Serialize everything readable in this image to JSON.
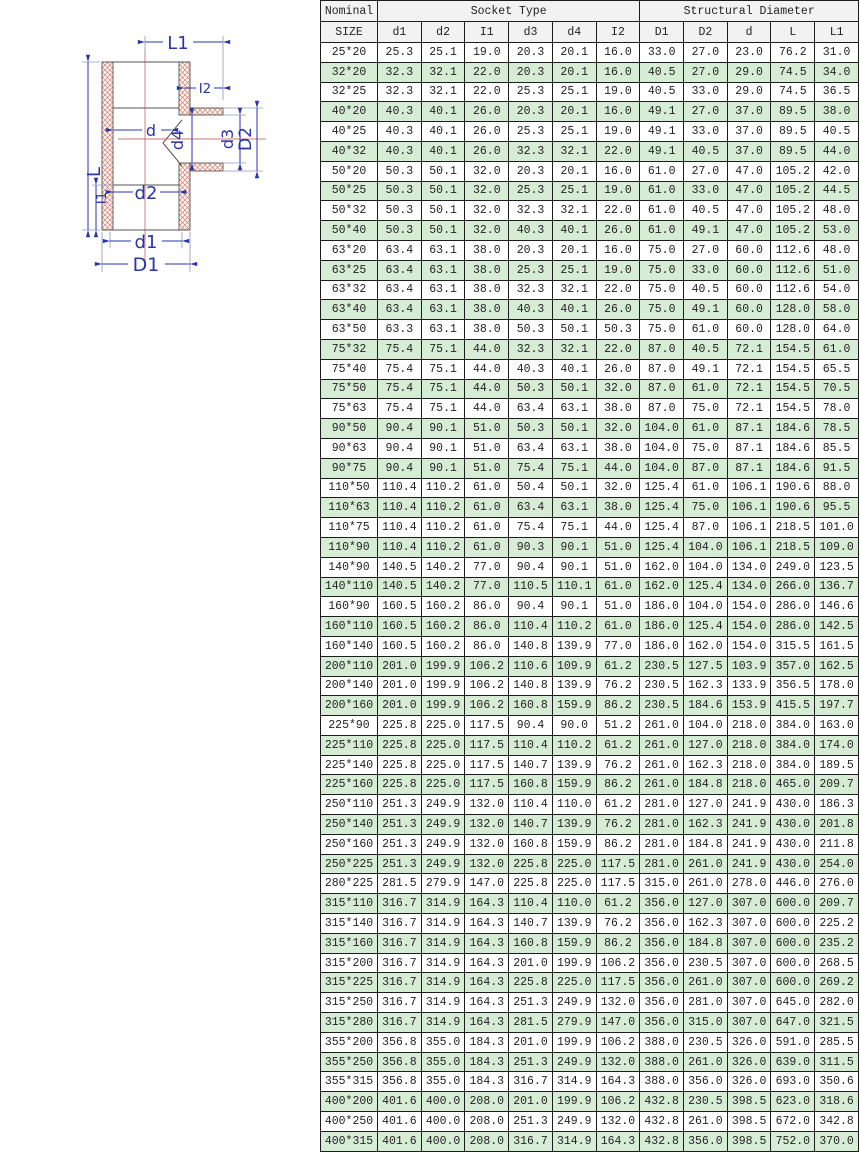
{
  "diagram": {
    "labels": {
      "L1": "L1",
      "I2": "I2",
      "d": "d",
      "d4": "d4",
      "d3": "d3",
      "D2": "D2",
      "L": "L",
      "I1": "I1",
      "d2": "d2",
      "d1": "d1",
      "D1": "D1"
    },
    "colors": {
      "dimension_blue": "#2a35a8",
      "outline_gray": "#555555",
      "hatch_red": "#cf6e5e",
      "centerline_red": "#c34a4a"
    }
  },
  "table": {
    "header": {
      "nominal": "Nominal",
      "size": "SIZE",
      "socket_group": "Socket Type",
      "structural_group": "Structural Diameter",
      "socket_cols": [
        "d1",
        "d2",
        "I1",
        "d3",
        "d4",
        "I2"
      ],
      "structural_cols": [
        "D1",
        "D2",
        "d",
        "L",
        "L1"
      ]
    },
    "row_alt_color": "#d6ecd5",
    "rows": [
      [
        "25*20",
        "25.3",
        "25.1",
        "19.0",
        "20.3",
        "20.1",
        "16.0",
        "33.0",
        "27.0",
        "23.0",
        "76.2",
        "31.0"
      ],
      [
        "32*20",
        "32.3",
        "32.1",
        "22.0",
        "20.3",
        "20.1",
        "16.0",
        "40.5",
        "27.0",
        "29.0",
        "74.5",
        "34.0"
      ],
      [
        "32*25",
        "32.3",
        "32.1",
        "22.0",
        "25.3",
        "25.1",
        "19.0",
        "40.5",
        "33.0",
        "29.0",
        "74.5",
        "36.5"
      ],
      [
        "40*20",
        "40.3",
        "40.1",
        "26.0",
        "20.3",
        "20.1",
        "16.0",
        "49.1",
        "27.0",
        "37.0",
        "89.5",
        "38.0"
      ],
      [
        "40*25",
        "40.3",
        "40.1",
        "26.0",
        "25.3",
        "25.1",
        "19.0",
        "49.1",
        "33.0",
        "37.0",
        "89.5",
        "40.5"
      ],
      [
        "40*32",
        "40.3",
        "40.1",
        "26.0",
        "32.3",
        "32.1",
        "22.0",
        "49.1",
        "40.5",
        "37.0",
        "89.5",
        "44.0"
      ],
      [
        "50*20",
        "50.3",
        "50.1",
        "32.0",
        "20.3",
        "20.1",
        "16.0",
        "61.0",
        "27.0",
        "47.0",
        "105.2",
        "42.0"
      ],
      [
        "50*25",
        "50.3",
        "50.1",
        "32.0",
        "25.3",
        "25.1",
        "19.0",
        "61.0",
        "33.0",
        "47.0",
        "105.2",
        "44.5"
      ],
      [
        "50*32",
        "50.3",
        "50.1",
        "32.0",
        "32.3",
        "32.1",
        "22.0",
        "61.0",
        "40.5",
        "47.0",
        "105.2",
        "48.0"
      ],
      [
        "50*40",
        "50.3",
        "50.1",
        "32.0",
        "40.3",
        "40.1",
        "26.0",
        "61.0",
        "49.1",
        "47.0",
        "105.2",
        "53.0"
      ],
      [
        "63*20",
        "63.4",
        "63.1",
        "38.0",
        "20.3",
        "20.1",
        "16.0",
        "75.0",
        "27.0",
        "60.0",
        "112.6",
        "48.0"
      ],
      [
        "63*25",
        "63.4",
        "63.1",
        "38.0",
        "25.3",
        "25.1",
        "19.0",
        "75.0",
        "33.0",
        "60.0",
        "112.6",
        "51.0"
      ],
      [
        "63*32",
        "63.4",
        "63.1",
        "38.0",
        "32.3",
        "32.1",
        "22.0",
        "75.0",
        "40.5",
        "60.0",
        "112.6",
        "54.0"
      ],
      [
        "63*40",
        "63.4",
        "63.1",
        "38.0",
        "40.3",
        "40.1",
        "26.0",
        "75.0",
        "49.1",
        "60.0",
        "128.0",
        "58.0"
      ],
      [
        "63*50",
        "63.3",
        "63.1",
        "38.0",
        "50.3",
        "50.1",
        "50.3",
        "75.0",
        "61.0",
        "60.0",
        "128.0",
        "64.0"
      ],
      [
        "75*32",
        "75.4",
        "75.1",
        "44.0",
        "32.3",
        "32.1",
        "22.0",
        "87.0",
        "40.5",
        "72.1",
        "154.5",
        "61.0"
      ],
      [
        "75*40",
        "75.4",
        "75.1",
        "44.0",
        "40.3",
        "40.1",
        "26.0",
        "87.0",
        "49.1",
        "72.1",
        "154.5",
        "65.5"
      ],
      [
        "75*50",
        "75.4",
        "75.1",
        "44.0",
        "50.3",
        "50.1",
        "32.0",
        "87.0",
        "61.0",
        "72.1",
        "154.5",
        "70.5"
      ],
      [
        "75*63",
        "75.4",
        "75.1",
        "44.0",
        "63.4",
        "63.1",
        "38.0",
        "87.0",
        "75.0",
        "72.1",
        "154.5",
        "78.0"
      ],
      [
        "90*50",
        "90.4",
        "90.1",
        "51.0",
        "50.3",
        "50.1",
        "32.0",
        "104.0",
        "61.0",
        "87.1",
        "184.6",
        "78.5"
      ],
      [
        "90*63",
        "90.4",
        "90.1",
        "51.0",
        "63.4",
        "63.1",
        "38.0",
        "104.0",
        "75.0",
        "87.1",
        "184.6",
        "85.5"
      ],
      [
        "90*75",
        "90.4",
        "90.1",
        "51.0",
        "75.4",
        "75.1",
        "44.0",
        "104.0",
        "87.0",
        "87.1",
        "184.6",
        "91.5"
      ],
      [
        "110*50",
        "110.4",
        "110.2",
        "61.0",
        "50.4",
        "50.1",
        "32.0",
        "125.4",
        "61.0",
        "106.1",
        "190.6",
        "88.0"
      ],
      [
        "110*63",
        "110.4",
        "110.2",
        "61.0",
        "63.4",
        "63.1",
        "38.0",
        "125.4",
        "75.0",
        "106.1",
        "190.6",
        "95.5"
      ],
      [
        "110*75",
        "110.4",
        "110.2",
        "61.0",
        "75.4",
        "75.1",
        "44.0",
        "125.4",
        "87.0",
        "106.1",
        "218.5",
        "101.0"
      ],
      [
        "110*90",
        "110.4",
        "110.2",
        "61.0",
        "90.3",
        "90.1",
        "51.0",
        "125.4",
        "104.0",
        "106.1",
        "218.5",
        "109.0"
      ],
      [
        "140*90",
        "140.5",
        "140.2",
        "77.0",
        "90.4",
        "90.1",
        "51.0",
        "162.0",
        "104.0",
        "134.0",
        "249.0",
        "123.5"
      ],
      [
        "140*110",
        "140.5",
        "140.2",
        "77.0",
        "110.5",
        "110.1",
        "61.0",
        "162.0",
        "125.4",
        "134.0",
        "266.0",
        "136.7"
      ],
      [
        "160*90",
        "160.5",
        "160.2",
        "86.0",
        "90.4",
        "90.1",
        "51.0",
        "186.0",
        "104.0",
        "154.0",
        "286.0",
        "146.6"
      ],
      [
        "160*110",
        "160.5",
        "160.2",
        "86.0",
        "110.4",
        "110.2",
        "61.0",
        "186.0",
        "125.4",
        "154.0",
        "286.0",
        "142.5"
      ],
      [
        "160*140",
        "160.5",
        "160.2",
        "86.0",
        "140.8",
        "139.9",
        "77.0",
        "186.0",
        "162.0",
        "154.0",
        "315.5",
        "161.5"
      ],
      [
        "200*110",
        "201.0",
        "199.9",
        "106.2",
        "110.6",
        "109.9",
        "61.2",
        "230.5",
        "127.5",
        "103.9",
        "357.0",
        "162.5"
      ],
      [
        "200*140",
        "201.0",
        "199.9",
        "106.2",
        "140.8",
        "139.9",
        "76.2",
        "230.5",
        "162.3",
        "133.9",
        "356.5",
        "178.0"
      ],
      [
        "200*160",
        "201.0",
        "199.9",
        "106.2",
        "160.8",
        "159.9",
        "86.2",
        "230.5",
        "184.6",
        "153.9",
        "415.5",
        "197.7"
      ],
      [
        "225*90",
        "225.8",
        "225.0",
        "117.5",
        "90.4",
        "90.0",
        "51.2",
        "261.0",
        "104.0",
        "218.0",
        "384.0",
        "163.0"
      ],
      [
        "225*110",
        "225.8",
        "225.0",
        "117.5",
        "110.4",
        "110.2",
        "61.2",
        "261.0",
        "127.0",
        "218.0",
        "384.0",
        "174.0"
      ],
      [
        "225*140",
        "225.8",
        "225.0",
        "117.5",
        "140.7",
        "139.9",
        "76.2",
        "261.0",
        "162.3",
        "218.0",
        "384.0",
        "189.5"
      ],
      [
        "225*160",
        "225.8",
        "225.0",
        "117.5",
        "160.8",
        "159.9",
        "86.2",
        "261.0",
        "184.8",
        "218.0",
        "465.0",
        "209.7"
      ],
      [
        "250*110",
        "251.3",
        "249.9",
        "132.0",
        "110.4",
        "110.0",
        "61.2",
        "281.0",
        "127.0",
        "241.9",
        "430.0",
        "186.3"
      ],
      [
        "250*140",
        "251.3",
        "249.9",
        "132.0",
        "140.7",
        "139.9",
        "76.2",
        "281.0",
        "162.3",
        "241.9",
        "430.0",
        "201.8"
      ],
      [
        "250*160",
        "251.3",
        "249.9",
        "132.0",
        "160.8",
        "159.9",
        "86.2",
        "281.0",
        "184.8",
        "241.9",
        "430.0",
        "211.8"
      ],
      [
        "250*225",
        "251.3",
        "249.9",
        "132.0",
        "225.8",
        "225.0",
        "117.5",
        "281.0",
        "261.0",
        "241.9",
        "430.0",
        "254.0"
      ],
      [
        "280*225",
        "281.5",
        "279.9",
        "147.0",
        "225.8",
        "225.0",
        "117.5",
        "315.0",
        "261.0",
        "278.0",
        "446.0",
        "276.0"
      ],
      [
        "315*110",
        "316.7",
        "314.9",
        "164.3",
        "110.4",
        "110.0",
        "61.2",
        "356.0",
        "127.0",
        "307.0",
        "600.0",
        "209.7"
      ],
      [
        "315*140",
        "316.7",
        "314.9",
        "164.3",
        "140.7",
        "139.9",
        "76.2",
        "356.0",
        "162.3",
        "307.0",
        "600.0",
        "225.2"
      ],
      [
        "315*160",
        "316.7",
        "314.9",
        "164.3",
        "160.8",
        "159.9",
        "86.2",
        "356.0",
        "184.8",
        "307.0",
        "600.0",
        "235.2"
      ],
      [
        "315*200",
        "316.7",
        "314.9",
        "164.3",
        "201.0",
        "199.9",
        "106.2",
        "356.0",
        "230.5",
        "307.0",
        "600.0",
        "268.5"
      ],
      [
        "315*225",
        "316.7",
        "314.9",
        "164.3",
        "225.8",
        "225.0",
        "117.5",
        "356.0",
        "261.0",
        "307.0",
        "600.0",
        "269.2"
      ],
      [
        "315*250",
        "316.7",
        "314.9",
        "164.3",
        "251.3",
        "249.9",
        "132.0",
        "356.0",
        "281.0",
        "307.0",
        "645.0",
        "282.0"
      ],
      [
        "315*280",
        "316.7",
        "314.9",
        "164.3",
        "281.5",
        "279.9",
        "147.0",
        "356.0",
        "315.0",
        "307.0",
        "647.0",
        "321.5"
      ],
      [
        "355*200",
        "356.8",
        "355.0",
        "184.3",
        "201.0",
        "199.9",
        "106.2",
        "388.0",
        "230.5",
        "326.0",
        "591.0",
        "285.5"
      ],
      [
        "355*250",
        "356.8",
        "355.0",
        "184.3",
        "251.3",
        "249.9",
        "132.0",
        "388.0",
        "261.0",
        "326.0",
        "639.0",
        "311.5"
      ],
      [
        "355*315",
        "356.8",
        "355.0",
        "184.3",
        "316.7",
        "314.9",
        "164.3",
        "388.0",
        "356.0",
        "326.0",
        "693.0",
        "350.6"
      ],
      [
        "400*200",
        "401.6",
        "400.0",
        "208.0",
        "201.0",
        "199.9",
        "106.2",
        "432.8",
        "230.5",
        "398.5",
        "623.0",
        "318.6"
      ],
      [
        "400*250",
        "401.6",
        "400.0",
        "208.0",
        "251.3",
        "249.9",
        "132.0",
        "432.8",
        "261.0",
        "398.5",
        "672.0",
        "342.8"
      ],
      [
        "400*315",
        "401.6",
        "400.0",
        "208.0",
        "316.7",
        "314.9",
        "164.3",
        "432.8",
        "356.0",
        "398.5",
        "752.0",
        "370.0"
      ]
    ]
  }
}
